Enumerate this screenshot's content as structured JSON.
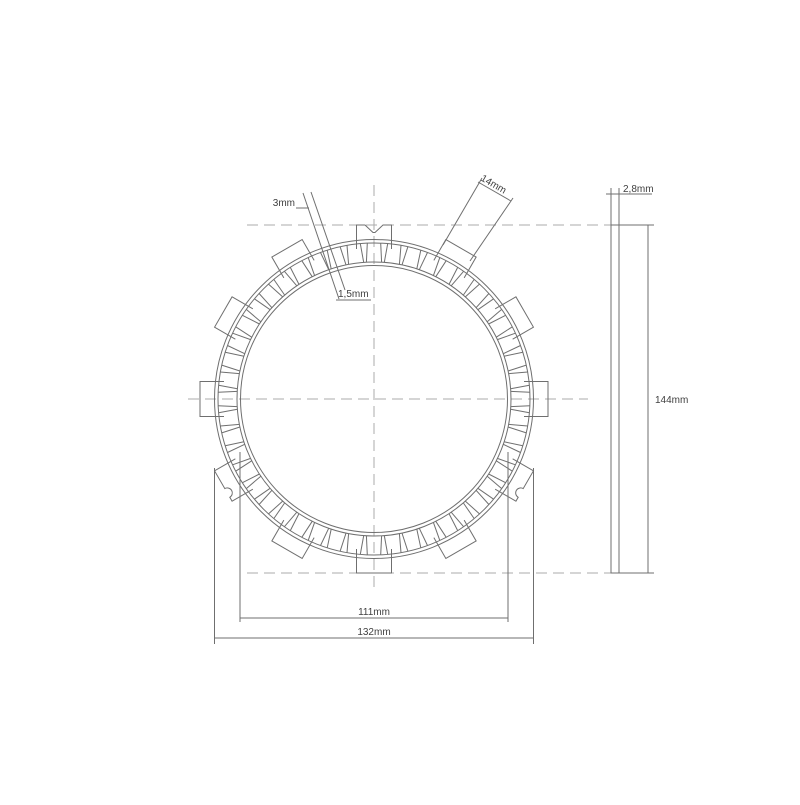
{
  "drawing": {
    "front_view": {
      "labels": {
        "slot_width_outer": "3mm",
        "tab_width": "14mm",
        "slot_width_inner": "1,5mm",
        "inner_diameter": "111mm",
        "outer_diameter": "132mm"
      }
    },
    "side_view": {
      "labels": {
        "thickness": "2,8mm",
        "overall_diameter": "144mm"
      }
    },
    "colors": {
      "line": "#6f6f6f",
      "centerline": "#ababab",
      "text": "#3f3f3f",
      "background": "#ffffff"
    }
  }
}
